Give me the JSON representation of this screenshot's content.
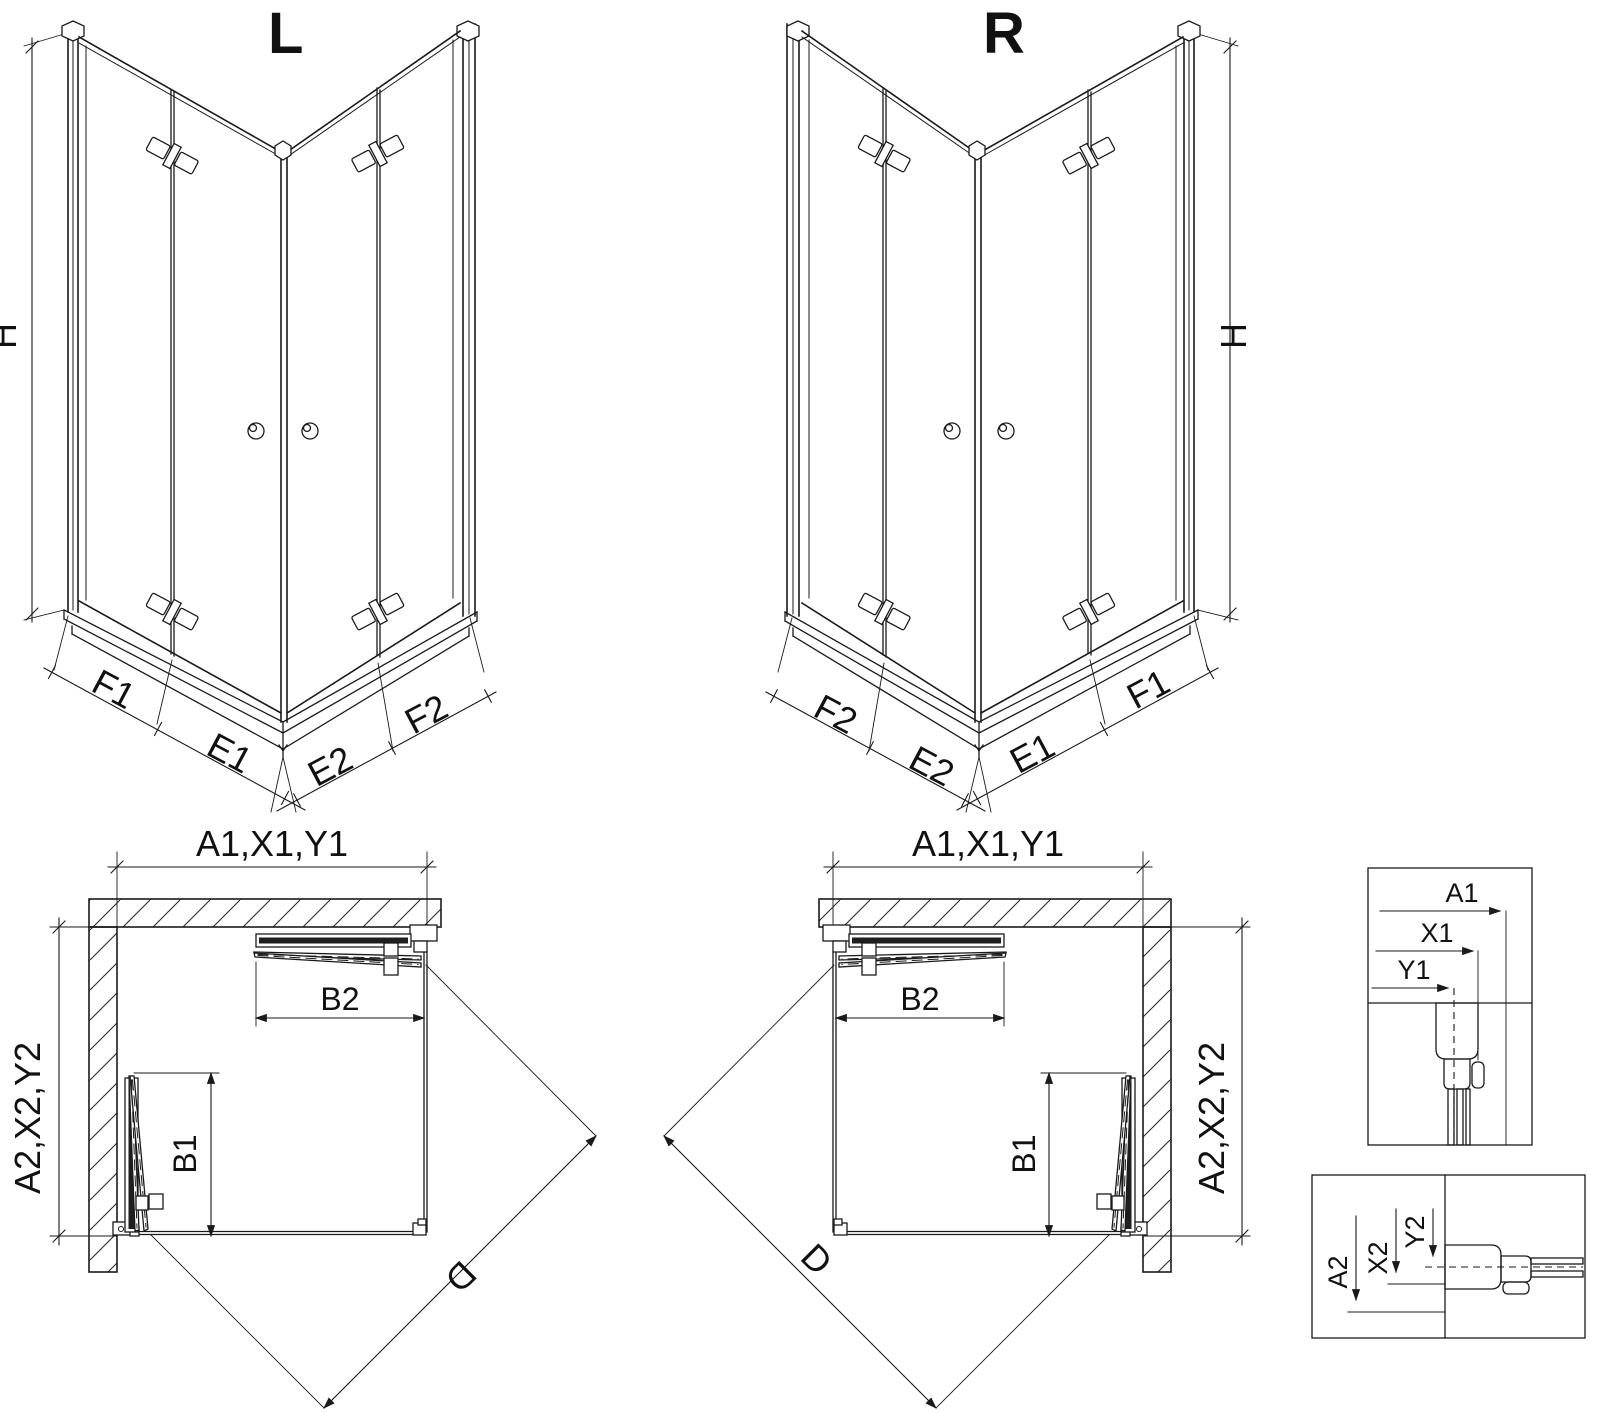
{
  "page": {
    "background": "#ffffff",
    "line_color": "#1a1a1a"
  },
  "perspective_left": {
    "title": "L",
    "height_label": "H",
    "face_left": {
      "outer": "F1",
      "inner": "E1"
    },
    "face_right": {
      "inner": "E2",
      "outer": "F2"
    }
  },
  "perspective_right": {
    "title": "R",
    "height_label": "H",
    "face_left": {
      "outer": "F2",
      "inner": "E2"
    },
    "face_right": {
      "inner": "E1",
      "outer": "F1"
    }
  },
  "plan_left": {
    "width_label": "A1,X1,Y1",
    "depth_label": "A2,X2,Y2",
    "door_top": "B2",
    "door_bottom": "B1",
    "diagonal_label": "D"
  },
  "plan_right": {
    "width_label": "A1,X1,Y1",
    "depth_label": "A2,X2,Y2",
    "door_top": "B2",
    "door_bottom": "B1",
    "diagonal_label": "D"
  },
  "detail_top": {
    "dim1": "A1",
    "dim2": "X1",
    "dim3": "Y1"
  },
  "detail_bottom": {
    "dim1": "A2",
    "dim2": "X2",
    "dim3": "Y2"
  }
}
